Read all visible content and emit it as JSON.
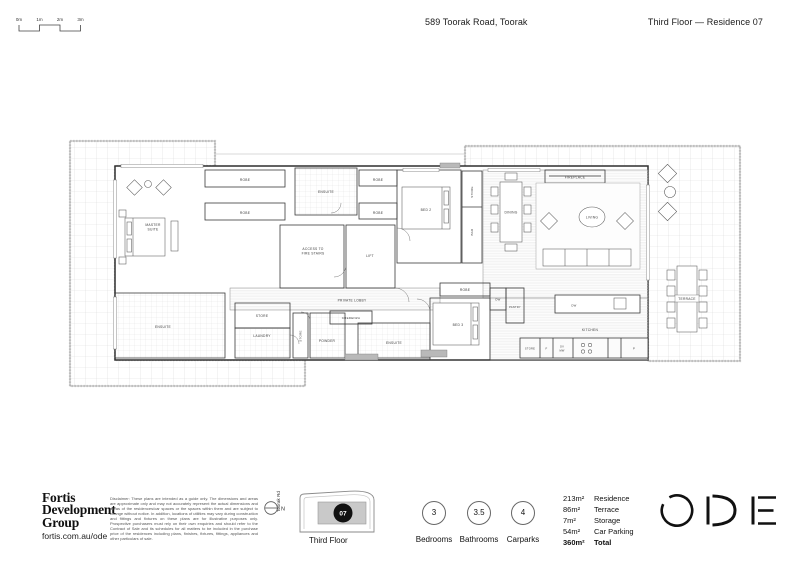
{
  "header": {
    "address": "589 Toorak Road, Toorak",
    "plan_title": "Third Floor — Residence 07"
  },
  "scale_bar": {
    "ticks": [
      "0m",
      "1m",
      "2m",
      "3m"
    ]
  },
  "plan": {
    "rooms": {
      "robe": "ROBE",
      "ensuite": "ENSUITE",
      "master1": "MASTER",
      "master2": "SUITE",
      "bed2": "BED 2",
      "bed3": "BED 3",
      "store": "STORE",
      "bar": "BAR",
      "fireplace": "FIREPLACE",
      "dining": "DINING",
      "living": "LIVING",
      "access1": "ACCESS TO",
      "access2": "FIRE STAIRS",
      "lift": "LIFT",
      "private_lobby": "PRIVATE LOBBY",
      "laundry": "LAUNDRY",
      "powder": "POWDER",
      "credenza": "CREDENZA",
      "pantry": "PANTRY",
      "kitchen": "KITCHEN",
      "terrace": "TERRACE",
      "dw": "DW",
      "f": "F",
      "ov": "OV",
      "mw": "MW",
      "p": "P"
    }
  },
  "footer": {
    "brand": {
      "line1": "Fortis",
      "line2": "Development",
      "line3": "Group",
      "url": "fortis.com.au/ode"
    },
    "disclaimer": "Disclaimer: These plans are intended as a guide only. The dimensions and areas are approximate only and may not accurately represent the actual dimensions and areas of the residences/car spaces or the spaces within them and are subject to change without notice. In addition, locations of utilities may vary during construction and fittings and fixtures on these plans are for illustrative purposes only. Prospective purchasers must rely on their own enquiries and should refer to the Contract of Sale and its schedules for all matters to be included in the purchase price of the residences including plans, finishes, fixtures, fittings, appliances and other particulars of sale.",
    "north_label": "N",
    "street_label": "Toorak Rd",
    "keyplan": {
      "unit": "07",
      "floor_label": "Third Floor"
    },
    "stats": [
      {
        "value": "3",
        "label": "Bedrooms"
      },
      {
        "value": "3.5",
        "label": "Bathrooms"
      },
      {
        "value": "4",
        "label": "Carparks"
      }
    ],
    "areas": [
      {
        "value": "213m²",
        "label": "Residence"
      },
      {
        "value": "86m²",
        "label": "Terrace"
      },
      {
        "value": "7m²",
        "label": "Storage"
      },
      {
        "value": "54m²",
        "label": "Car Parking"
      },
      {
        "value": "360m²",
        "label": "Total"
      }
    ],
    "logo": "ODE"
  }
}
